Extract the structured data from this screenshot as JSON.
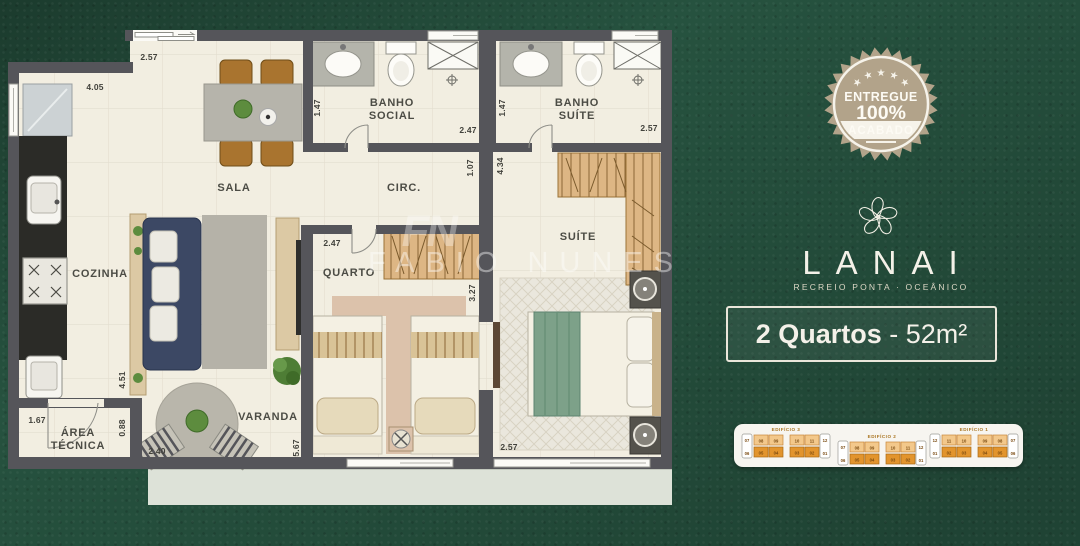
{
  "colors": {
    "background_green": "#26523f",
    "wall_gray": "#55555a",
    "floor_cream": "#f2eee1",
    "badge_tan": "#b2a38a",
    "keyplan_orange": "#e2942d",
    "text_white": "#f4f1e9"
  },
  "watermark": {
    "monogram": "FN",
    "name": "FABIO NUNES"
  },
  "badge": {
    "line1": "ENTREGUE",
    "line2": "100%",
    "line3": "ACABADO"
  },
  "logo": {
    "icon": "plumeria-flower-icon",
    "name": "LANAI",
    "tagline": "RECREIO PONTA · OCEÂNICO"
  },
  "unit": {
    "rooms": "2 Quartos",
    "area": " - 52m²"
  },
  "floor_plan": {
    "rooms": {
      "sala": "SALA",
      "cozinha": "COZINHA",
      "banho_social_1": "BANHO",
      "banho_social_2": "SOCIAL",
      "banho_suite_1": "BANHO",
      "banho_suite_2": "SUÍTE",
      "circ": "CIRC.",
      "quarto": "QUARTO",
      "suite": "SUÍTE",
      "varanda": "VARANDA",
      "area_tecnica_1": "ÁREA",
      "area_tecnica_2": "TÉCNICA"
    },
    "dims": {
      "sala_top": "2.57",
      "cozinha_top": "4.05",
      "bsocial_w": "1.47",
      "bsocial_l": "2.47",
      "bsuite_w": "1.47",
      "bsuite_l": "2.57",
      "circ_w": "1.07",
      "suite_l": "4.34",
      "quarto_w": "2.47",
      "quarto_l": "3.27",
      "sala_l": "4.51",
      "areatec_l": "0.88",
      "areatec_w": "1.67",
      "varanda_w": "2.40",
      "varanda_l": "5.67",
      "suite_w": "2.57"
    }
  },
  "keyplans": {
    "buildings": [
      {
        "label": "EDIFÍCIO 3",
        "top": [
          "07",
          "08",
          "09",
          "10",
          "11",
          "12"
        ],
        "bottom": [
          "06",
          "05",
          "04",
          "03",
          "02",
          "01"
        ]
      },
      {
        "label": "EDIFÍCIO 2",
        "top": [
          "07",
          "08",
          "09",
          "10",
          "11",
          "12"
        ],
        "bottom": [
          "06",
          "05",
          "04",
          "03",
          "02",
          "01"
        ]
      },
      {
        "label": "EDIFÍCIO 1",
        "top": [
          "12",
          "11",
          "10",
          "09",
          "08",
          "07"
        ],
        "bottom": [
          "01",
          "02",
          "03",
          "04",
          "05",
          "06"
        ]
      }
    ]
  }
}
